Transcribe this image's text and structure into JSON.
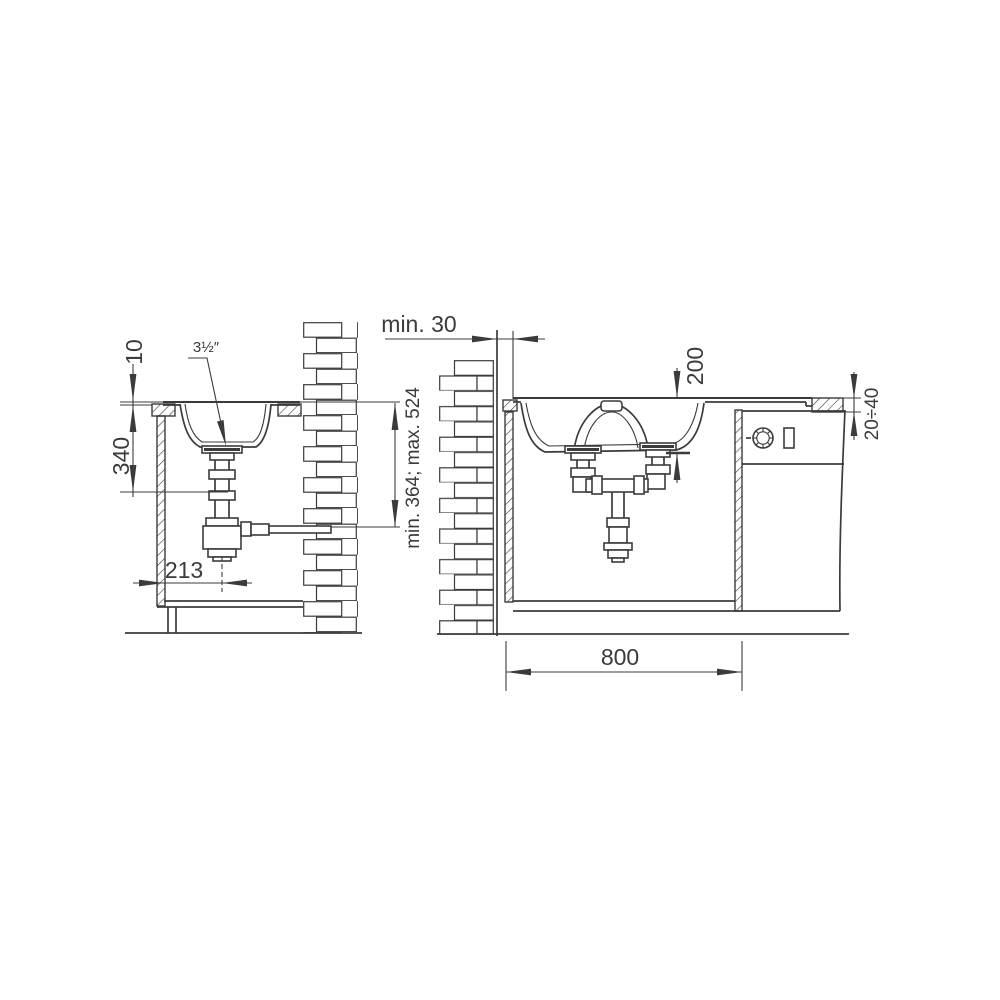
{
  "diagram": {
    "type": "sink-installation-technical-drawing",
    "background": "#ffffff",
    "line_color": "#3b3b3b",
    "left": {
      "view": "side-section-view",
      "labels": {
        "rim_height": "10",
        "drain_size": "3½″",
        "bowl_depth": "340",
        "siphon_offset": "213",
        "outlet_height_range": "min. 364; max. 524"
      }
    },
    "right": {
      "view": "front-section-view",
      "labels": {
        "wall_clearance": "min. 30",
        "bowl_depth": "200",
        "worktop_thickness": "20÷40",
        "cabinet_width": "800"
      }
    }
  }
}
